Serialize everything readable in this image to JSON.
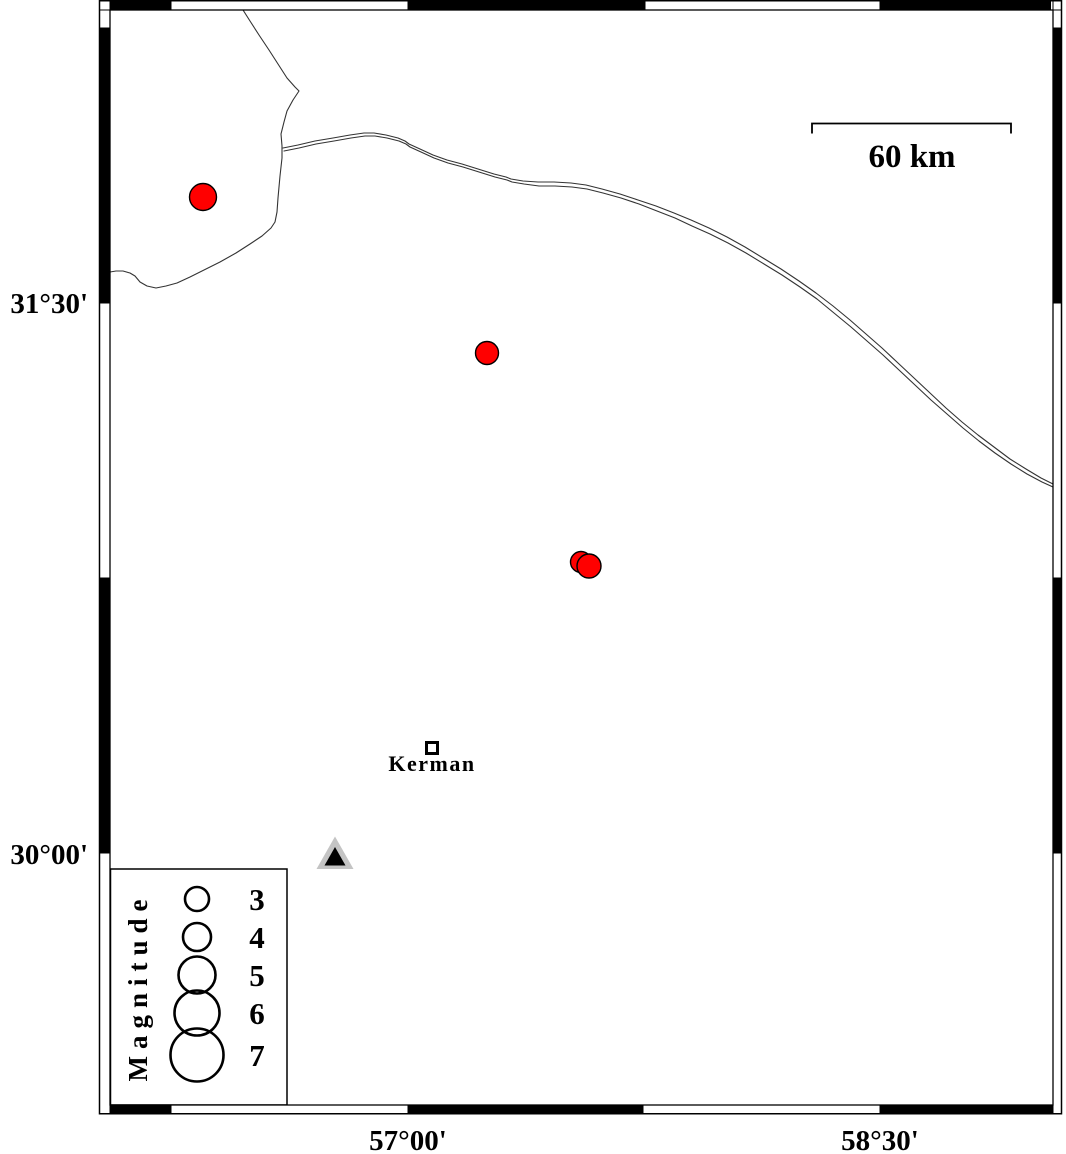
{
  "figure": {
    "kind": "epicenter-map",
    "frame": {
      "y_tick_labels": [
        {
          "label": "31°30'"
        },
        {
          "label": "30°00'"
        }
      ],
      "x_tick_labels": [
        {
          "label": "57°00'"
        },
        {
          "label": "58°30'"
        }
      ]
    },
    "scalebar": {
      "label": "60 km"
    },
    "city": {
      "label": "Kerman"
    },
    "legend": {
      "title": "Magnitude",
      "entries": [
        {
          "label": "3",
          "y": 899,
          "r": 12
        },
        {
          "label": "4",
          "y": 937,
          "r": 14
        },
        {
          "label": "5",
          "y": 975,
          "r": 18.5
        },
        {
          "label": "6",
          "y": 1013,
          "r": 22.5
        },
        {
          "label": "7",
          "y": 1055,
          "r": 26.5
        }
      ]
    },
    "epicenters": [
      {
        "x": 203,
        "y": 197,
        "r": 13.5
      },
      {
        "x": 487,
        "y": 353,
        "r": 11.5
      },
      {
        "x": 581,
        "y": 562,
        "r": 10.5
      },
      {
        "x": 589,
        "y": 566,
        "r": 12
      }
    ],
    "colors": {
      "epicenter": "#ff0000",
      "station_outer": "#c4c4c4",
      "station_inner": "#000000",
      "line": "#333333"
    }
  }
}
